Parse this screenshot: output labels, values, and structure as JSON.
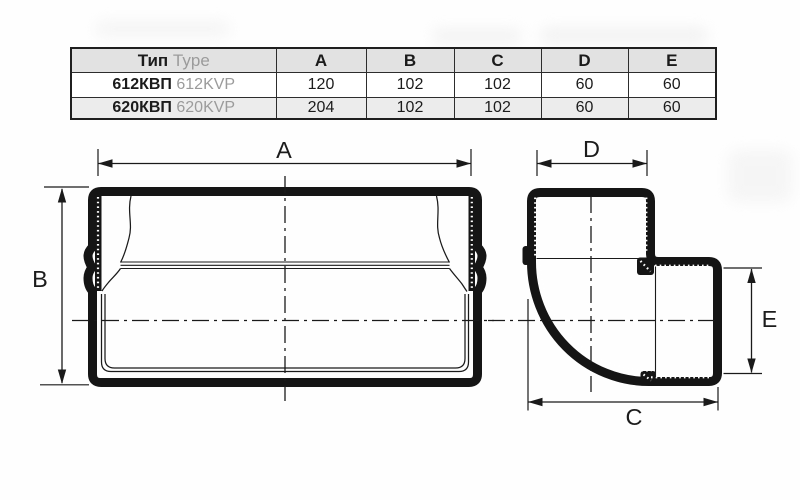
{
  "table": {
    "header": {
      "type_ru": "Тип",
      "type_en": "Type",
      "cols": [
        "A",
        "B",
        "C",
        "D",
        "E"
      ]
    },
    "rows": [
      {
        "type_ru": "612КВП",
        "type_en": "612KVP",
        "values": [
          "120",
          "102",
          "102",
          "60",
          "60"
        ]
      },
      {
        "type_ru": "620КВП",
        "type_en": "620KVP",
        "values": [
          "204",
          "102",
          "102",
          "60",
          "60"
        ]
      }
    ]
  },
  "drawing_labels": {
    "a": "A",
    "b": "B",
    "c": "C",
    "d": "D",
    "e": "E"
  },
  "colors": {
    "line": "#1a1a1a",
    "table_header_bg": "#e2e2e2",
    "table_alt_row_bg": "#ececec",
    "muted_text": "#9b9b9b"
  }
}
